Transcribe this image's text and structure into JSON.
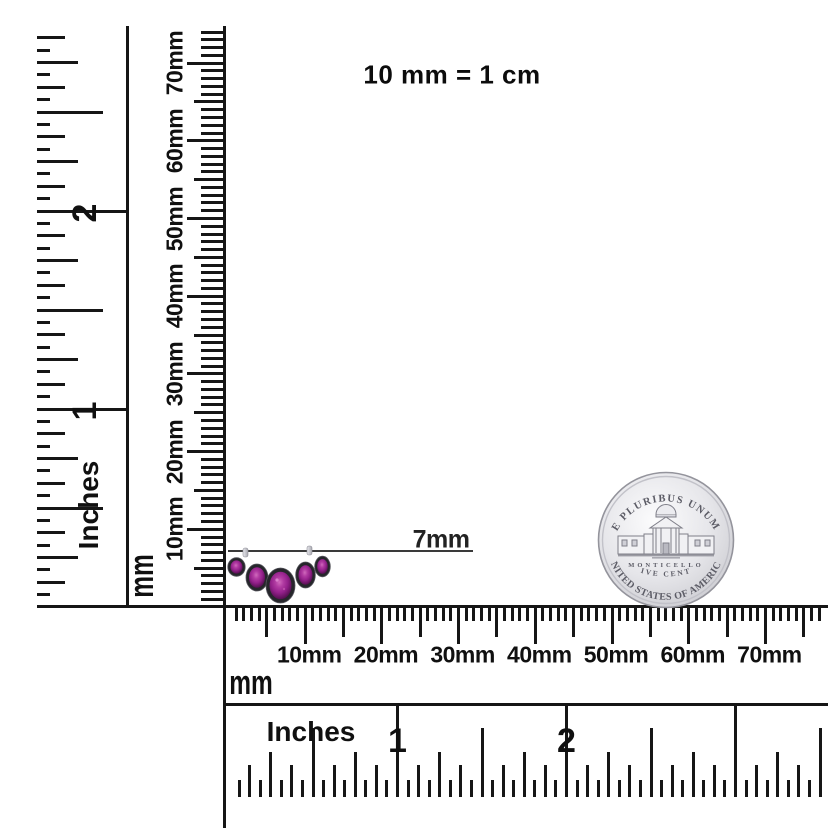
{
  "title_note": "10 mm = 1 cm",
  "dimension_label": "7mm",
  "left_inch_ruler": {
    "unit": "Inches",
    "numbers": [
      "1",
      "2"
    ]
  },
  "vertical_mm_ruler": {
    "unit": "mm",
    "labels": [
      "10mm",
      "20mm",
      "30mm",
      "40mm",
      "50mm",
      "60mm",
      "70mm"
    ]
  },
  "bottom_mm_ruler": {
    "unit": "mm",
    "labels": [
      "10mm",
      "20mm",
      "30mm",
      "40mm",
      "50mm",
      "60mm",
      "70mm"
    ]
  },
  "bottom_inch_ruler": {
    "unit": "Inches",
    "numbers": [
      "1",
      "2"
    ]
  },
  "coin": {
    "legend_top": "E PLURIBUS UNUM",
    "building": "MONTICELLO",
    "denomination": "FIVE CENTS",
    "legend_bottom": "UNITED STATES OF AMERICA"
  },
  "jewelry": {
    "description": "curved five-stone bezel-set gemstone earring",
    "stone_count": 5,
    "measured_width": "7mm",
    "gem_color": "#93208a",
    "bezel_color": "#26262b"
  },
  "colors": {
    "background": "#ffffff",
    "ink": "#161616",
    "coin_silver": "#d8d8dc",
    "measure_line": "#3a3a3a"
  }
}
